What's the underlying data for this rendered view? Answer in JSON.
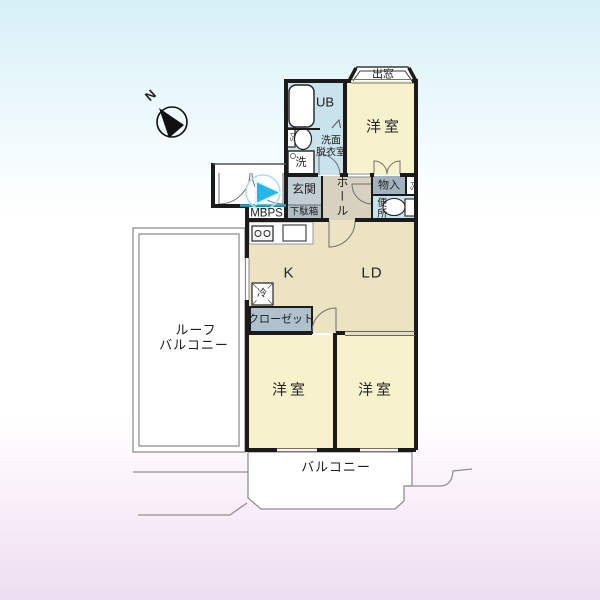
{
  "compass": {
    "north_label": "N"
  },
  "floorplan": {
    "labels": {
      "bay_window": "出窓",
      "unit_bath": "UB",
      "bedroom_top": "洋室",
      "washroom_line1": "洗面",
      "washroom_line2": "脱衣室",
      "washing_machine": "洗",
      "pipe_space": "PS",
      "entrance": "玄関",
      "shoe_cabinet": "下駄箱",
      "hall": "ホール",
      "storage": "物入",
      "toilet": "便所",
      "meter_box": "MBPS",
      "kitchen": "K",
      "living_dining": "LD",
      "refrigerator": "冷",
      "closet": "クローゼット",
      "roof_balcony_line1": "ルーフ",
      "roof_balcony_line2": "バルコニー",
      "bedroom_bottom_left": "洋室",
      "bedroom_bottom_right": "洋室",
      "balcony": "バルコニー"
    },
    "colors": {
      "background_top": "#d7eff7",
      "background_bottom": "#eeddf1",
      "room_cream": "#f7f2cc",
      "room_tan": "#ebe3c2",
      "hall_beige": "#d7d2bf",
      "wet_area_blue": "#c9e3ed",
      "entrance_gray_blue": "#c2cdd4",
      "storage_gray": "#a2b3be",
      "closet_gray": "#aec1cd",
      "shoe_cabinet_gray": "#b2bdc3",
      "sliding_door_tan": "#e6dec0",
      "wall": "#1b1b1b",
      "entrance_marker_cyan": "#29b5e6"
    }
  }
}
